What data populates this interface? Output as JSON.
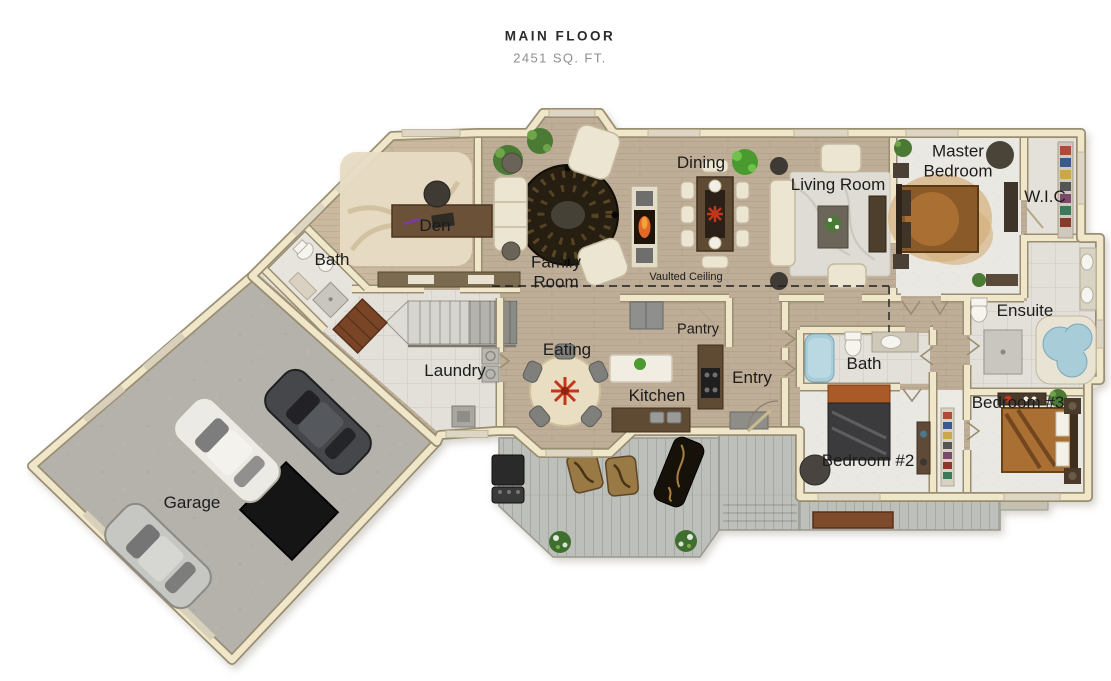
{
  "title": {
    "heading": "MAIN FLOOR",
    "subheading": "2451 SQ. FT."
  },
  "rooms": [
    {
      "name": "den",
      "label": "Den"
    },
    {
      "name": "bath-main",
      "label": "Bath"
    },
    {
      "name": "family-room",
      "label": "Family Room"
    },
    {
      "name": "dining",
      "label": "Dining"
    },
    {
      "name": "living-room",
      "label": "Living Room"
    },
    {
      "name": "master-bedroom",
      "label": "Master Bedroom"
    },
    {
      "name": "wic",
      "label": "W.I.C"
    },
    {
      "name": "ensuite",
      "label": "Ensuite"
    },
    {
      "name": "laundry",
      "label": "Laundry"
    },
    {
      "name": "eating",
      "label": "Eating"
    },
    {
      "name": "kitchen",
      "label": "Kitchen"
    },
    {
      "name": "pantry",
      "label": "Pantry"
    },
    {
      "name": "entry",
      "label": "Entry"
    },
    {
      "name": "bath-hall",
      "label": "Bath"
    },
    {
      "name": "bedroom-2",
      "label": "Bedroom #2"
    },
    {
      "name": "bedroom-3",
      "label": "Bedroom #3"
    },
    {
      "name": "garage",
      "label": "Garage"
    }
  ],
  "annotations": {
    "vaulted_ceiling": "Vaulted Ceiling"
  },
  "colors": {
    "wood": "#bfae97",
    "wood_light": "#cab89f",
    "tile": "#e3e0d9",
    "carpet": "#eae8e2",
    "deck": "#bcbfba",
    "concrete": "#b5b2ac",
    "wall": "#f0e6ca",
    "wall_edge": "#9a8e72",
    "water": "#a8ccd8",
    "accent_red": "#c0371b",
    "rug_dark": "#261e10",
    "text": "#1c1c1c",
    "muted": "#8f8f8f"
  }
}
